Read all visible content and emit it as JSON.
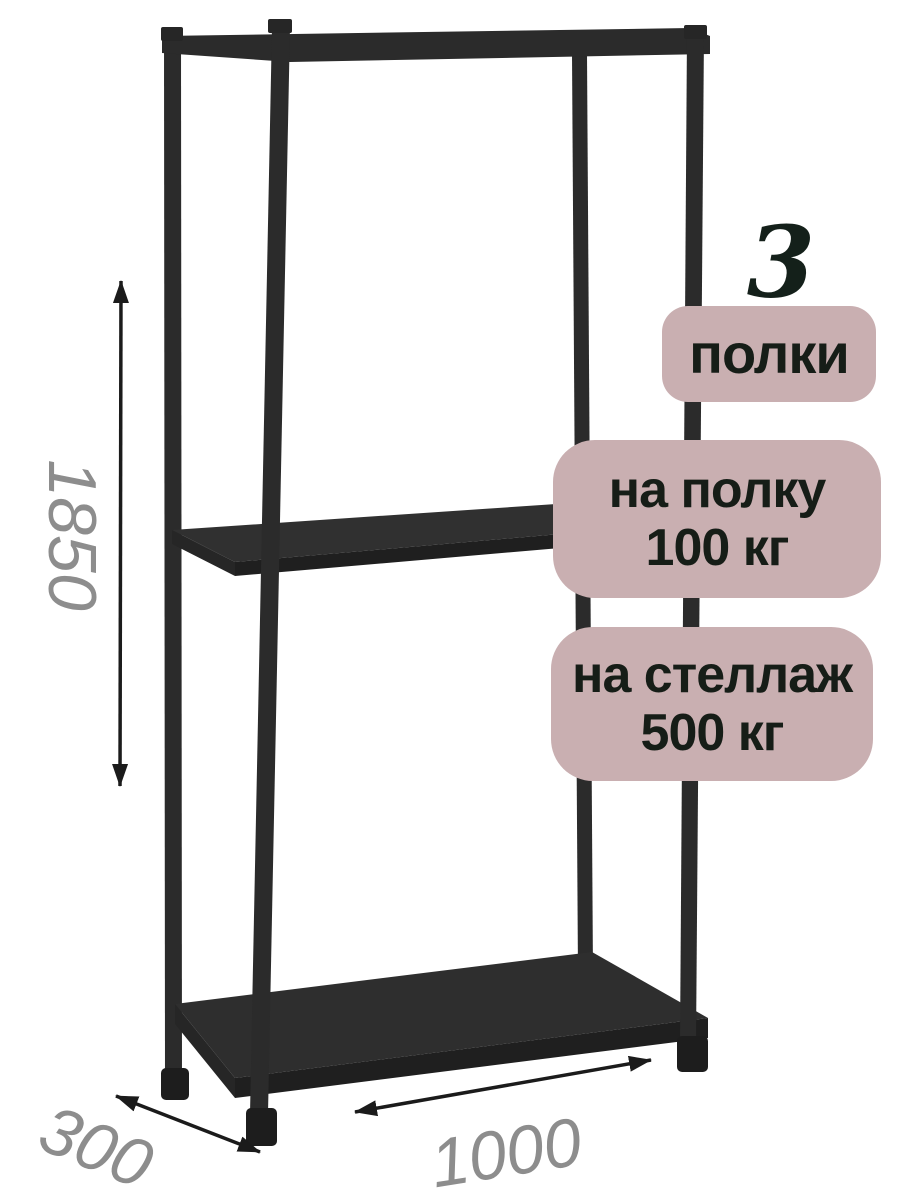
{
  "image_type": "product-photo-with-annotations",
  "colors": {
    "background": "#ffffff",
    "rack_metal": "#2b2b2b",
    "rack_shadow": "#1f1f1f",
    "badge_background": "#c9afb1",
    "badge_text": "#161d17",
    "dimension_text": "#8d8d8d",
    "arrow": "#1b1b1b"
  },
  "badges": {
    "shelf_count": {
      "number": "3",
      "label": "полки"
    },
    "shelf_load": {
      "line1": "на полку",
      "line2": "100 кг"
    },
    "rack_load": {
      "line1": "на стеллаж",
      "line2": "500 кг"
    }
  },
  "dimensions": {
    "height": "1850",
    "depth": "300",
    "width": "1000"
  }
}
